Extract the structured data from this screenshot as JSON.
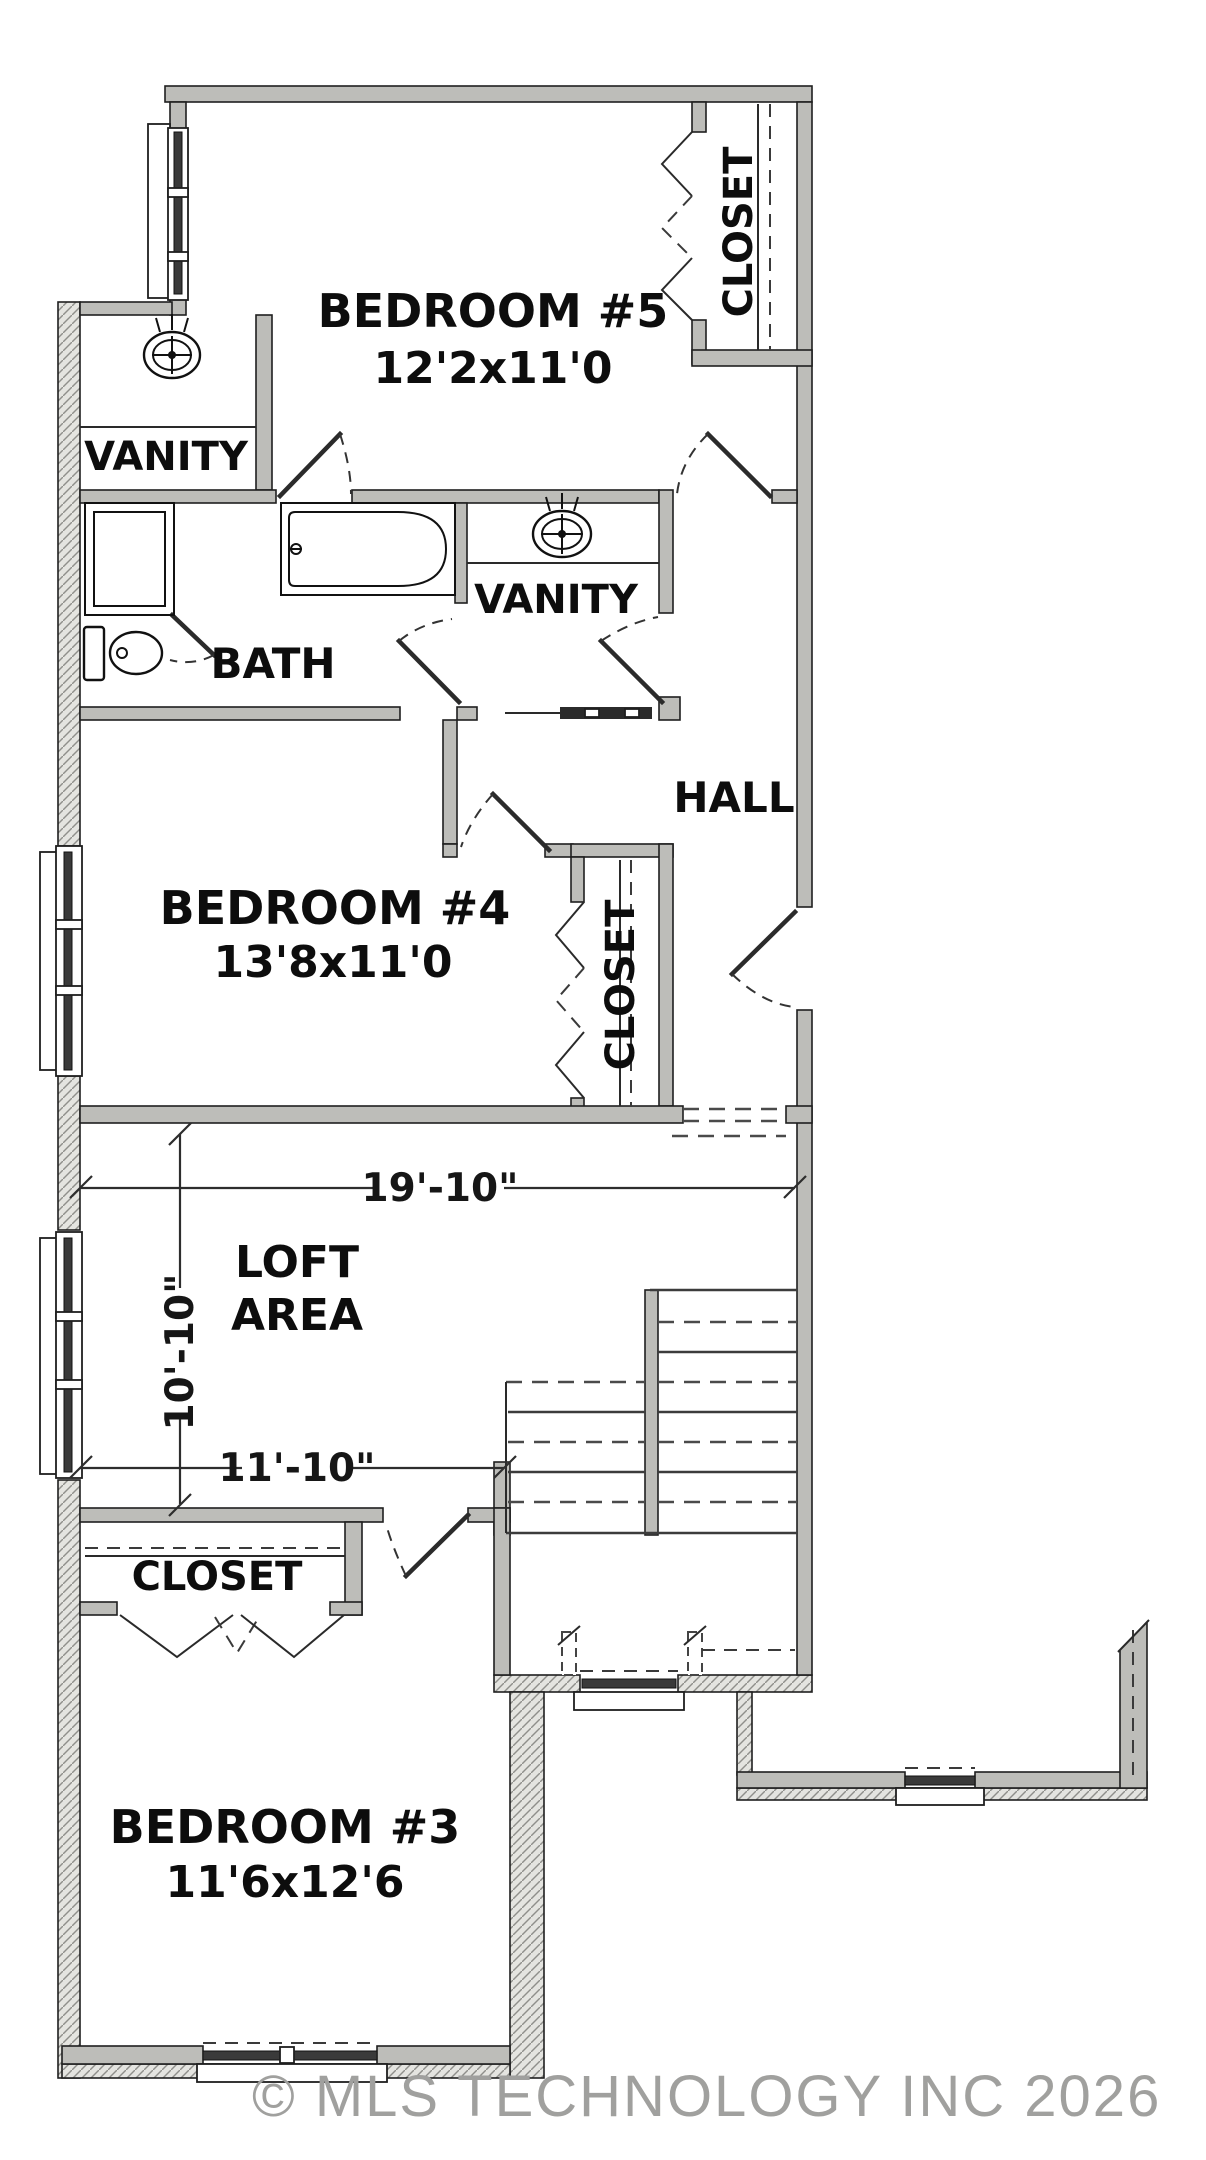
{
  "document": {
    "type": "residential second-floor plan",
    "watermark": "© MLS TECHNOLOGY INC 2026"
  },
  "colors": {
    "wall_fill": "#bdbdb9",
    "hatch_base": "#e4e4e0",
    "line": "#1f1f1f",
    "watermark_text": "#a0a09e"
  },
  "rooms": {
    "bedroom5": {
      "name": "BEDROOM #5",
      "size": "12'2x11'0"
    },
    "bedroom4": {
      "name": "BEDROOM #4",
      "size": "13'8x11'0"
    },
    "bedroom3": {
      "name": "BEDROOM #3",
      "size": "11'6x12'6"
    },
    "loft": {
      "name_line1": "LOFT",
      "name_line2": "AREA"
    },
    "hall": {
      "name": "HALL"
    },
    "bath": {
      "name": "BATH"
    },
    "vanity_upper": {
      "name": "VANITY"
    },
    "vanity_middle": {
      "name": "VANITY"
    },
    "closet_bedroom5": {
      "name": "CLOSET"
    },
    "closet_bedroom4": {
      "name": "CLOSET"
    },
    "closet_bedroom3": {
      "name": "CLOSET"
    }
  },
  "dimensions": {
    "loft_width": "19'-10\"",
    "loft_depth": "10'-10\"",
    "loft_lower_width": "11'-10\""
  }
}
